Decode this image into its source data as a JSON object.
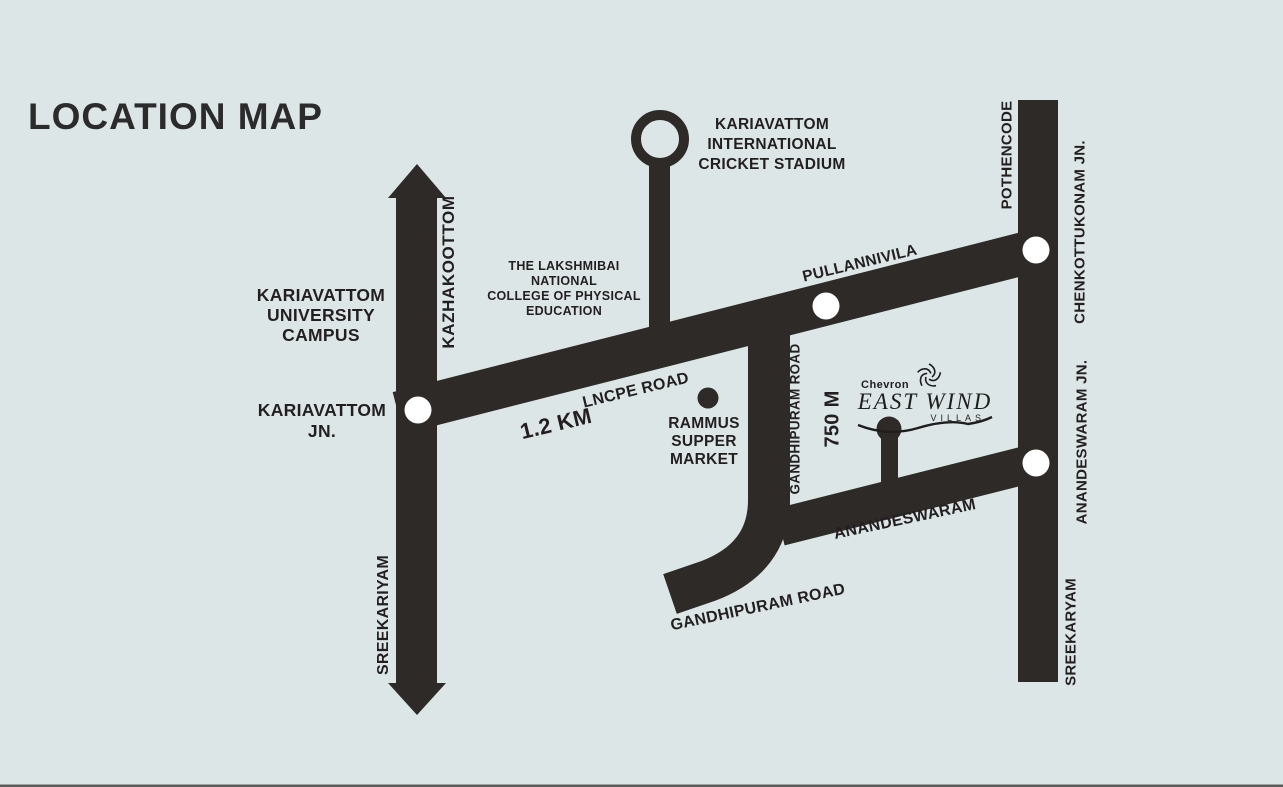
{
  "title": "LOCATION MAP",
  "colors": {
    "background": "#dde6e7",
    "road": "#2d2a27",
    "text": "#231f20",
    "junction_dot": "#ffffff"
  },
  "labels": {
    "kazhakoottom": "KAZHAKOOTTOM",
    "sreekariyam_left": "SREEKARIYAM",
    "university_campus": "KARIAVATTOM\nUNIVERSITY\nCAMPUS",
    "kariavattom_jn": "KARIAVATTOM\nJN.",
    "cricket_stadium": "KARIAVATTOM\nINTERNATIONAL\nCRICKET STADIUM",
    "lncpe_college": "THE LAKSHMIBAI\nNATIONAL\nCOLLEGE OF PHYSICAL\nEDUCATION",
    "lncpe_road": "LNCPE ROAD",
    "distance_lncpe": "1.2 KM",
    "pullannivila": "PULLANNIVILA",
    "rammus_market": "RAMMUS\nSUPPER\nMARKET",
    "gandhipuram_road_vertical": "GANDHIPURAM ROAD",
    "distance_gandhipuram": "750 M",
    "anandeswaram_road": "ANANDESWARAM",
    "gandhipuram_road_bottom": "GANDHIPURAM ROAD",
    "pothencode": "POTHENCODE",
    "chenkottukonam_jn": "CHENKOTTUKONAM JN.",
    "anandeswaram_jn": "ANANDESWARAM JN.",
    "sreekaryam_right": "SREEKARYAM"
  },
  "logo": {
    "brand": "Chevron",
    "name": "EAST WIND",
    "subtitle": "VILLAS"
  }
}
